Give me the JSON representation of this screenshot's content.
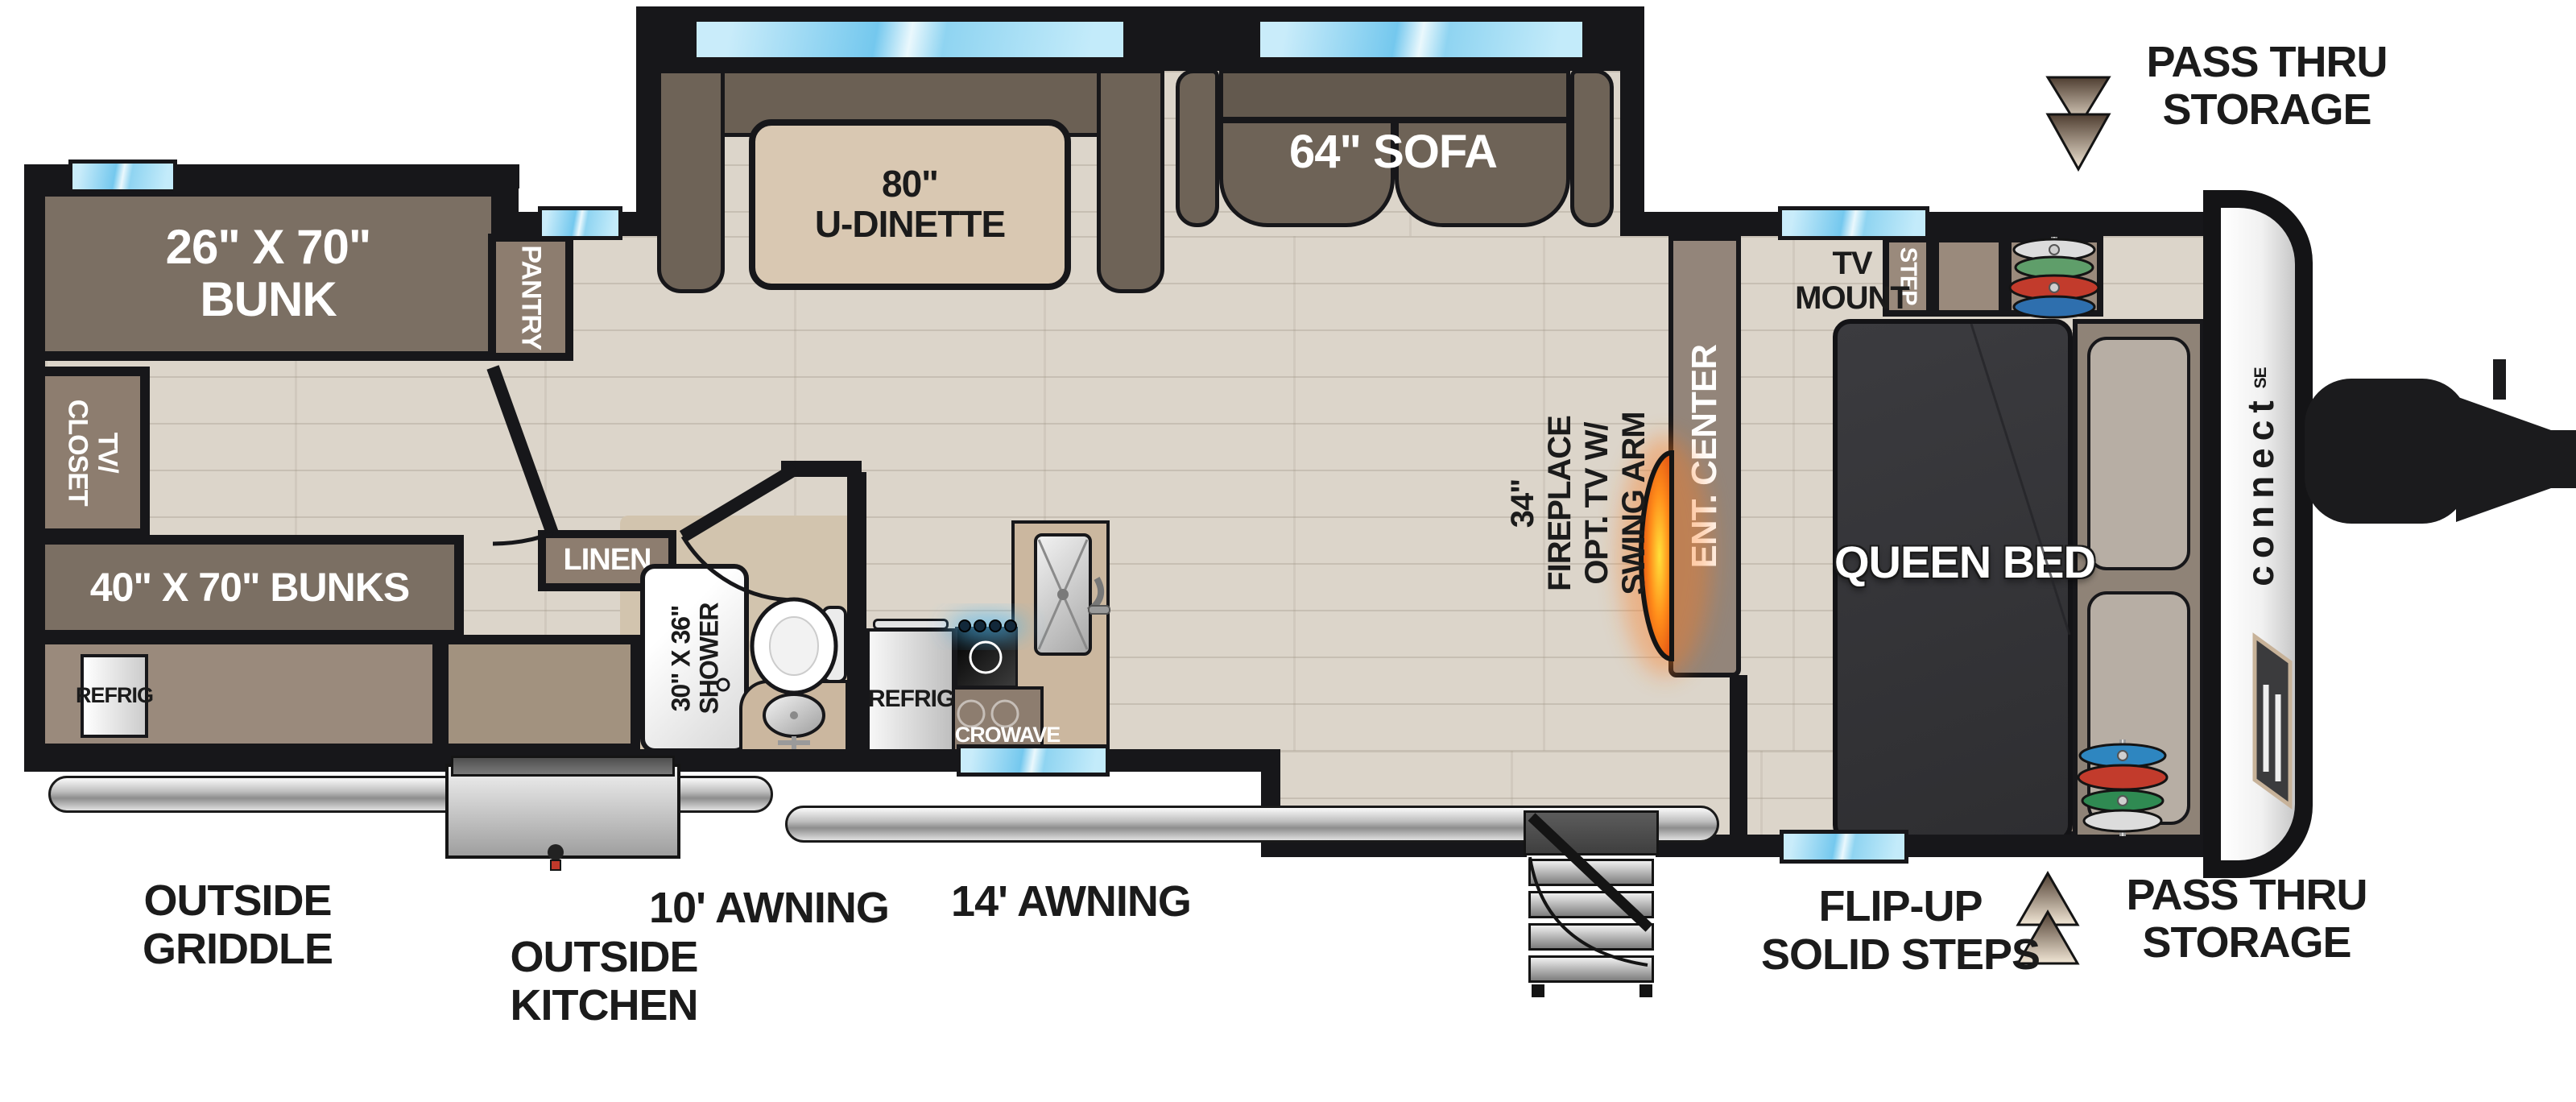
{
  "title": "Travel trailer floor plan - Connect SE",
  "brand": {
    "name": "connect",
    "sub": "SE"
  },
  "labels": {
    "bunk": {
      "l1": "26\" X 70\"",
      "l2": "BUNK"
    },
    "tv_closet": {
      "l1": "TV/",
      "l2": "CLOSET"
    },
    "bunks": "40\" X 70\" BUNKS",
    "refrig_out": "REFRIG",
    "pantry": "PANTRY",
    "dinette": {
      "l1": "80\"",
      "l2": "U-DINETTE"
    },
    "sofa": "64\" SOFA",
    "linen": "LINEN",
    "shower": {
      "l1": "30\" X 36\"",
      "l2": "SHOWER"
    },
    "refrig_in": "REFRIG",
    "microwave": "MICROWAVE",
    "fireplace": {
      "l1": "34\"",
      "l2": "FIREPLACE",
      "l3": "OPT. TV W/",
      "l4": "SWING ARM"
    },
    "ent_center": "ENT. CENTER",
    "tv_mount": {
      "l1": "TV",
      "l2": "MOUNT"
    },
    "step": "STEP",
    "queen_bed": "QUEEN BED",
    "pass_thru_top": {
      "l1": "PASS THRU",
      "l2": "STORAGE"
    },
    "pass_thru_bottom": {
      "l1": "PASS THRU",
      "l2": "STORAGE"
    },
    "outside_griddle": {
      "l1": "OUTSIDE",
      "l2": "GRIDDLE"
    },
    "outside_kitchen": {
      "l1": "OUTSIDE",
      "l2": "KITCHEN"
    },
    "awning_10": "10' AWNING",
    "awning_14": "14' AWNING",
    "flip_steps": {
      "l1": "FLIP-UP",
      "l2": "SOLID STEPS"
    }
  },
  "colors": {
    "wall": "#17171a",
    "window_blue": "#74c8ee",
    "cabinet_brown": "#8d7d6f",
    "furniture_brown": "#6b6054",
    "floor_wood": "#dcd5ca",
    "counter_tan": "#cbb79f",
    "bed_charcoal": "#36363a",
    "fireplace_orange": "#ff7a1a",
    "clothes": {
      "white": "#dcdcdc",
      "green": "#5f9e6a",
      "red": "#c23b2c",
      "blue": "#2e6fae"
    }
  }
}
